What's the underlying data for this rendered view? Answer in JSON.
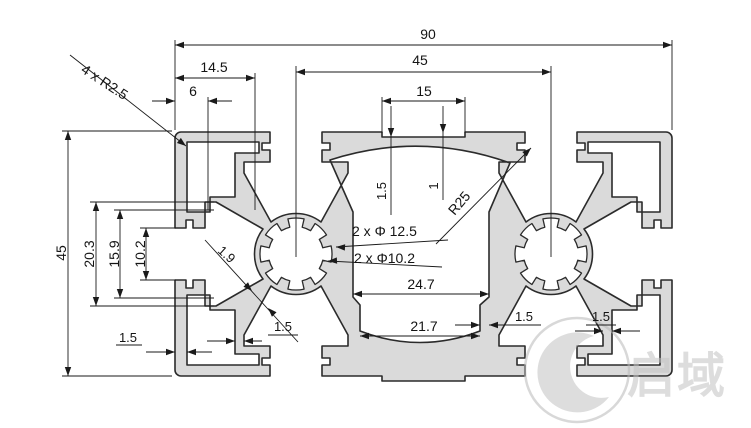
{
  "drawing": {
    "type": "aluminium-profile-cross-section",
    "dims": {
      "total_width": "90",
      "center_section_width": "45",
      "top_slot_spacing": "15",
      "corner_flange_width": "14.5",
      "edge_to_slot": "6",
      "corner_radius_note": "4 x R2.5",
      "total_height": "45",
      "side_slot_outer_width": "20.3",
      "side_slot_inner_width": "15.9",
      "side_slot_opening": "10.2",
      "wall_left": "1.5",
      "wall_bottom_left_inner": "1.5",
      "wall_bottom_center": "1.5",
      "wall_bottom_right_inner": "1.5",
      "web_thickness": "1.9",
      "bore_note_large": "2 x Φ 12.5",
      "bore_note_small": "2 x Φ10.2",
      "cavity_arc_radius": "R25",
      "cavity_width": "24.7",
      "cavity_neck_width": "21.7",
      "top_wall_thickness": "1.5",
      "top_groove_depth": "1"
    },
    "watermark": {
      "text": "启域"
    }
  }
}
